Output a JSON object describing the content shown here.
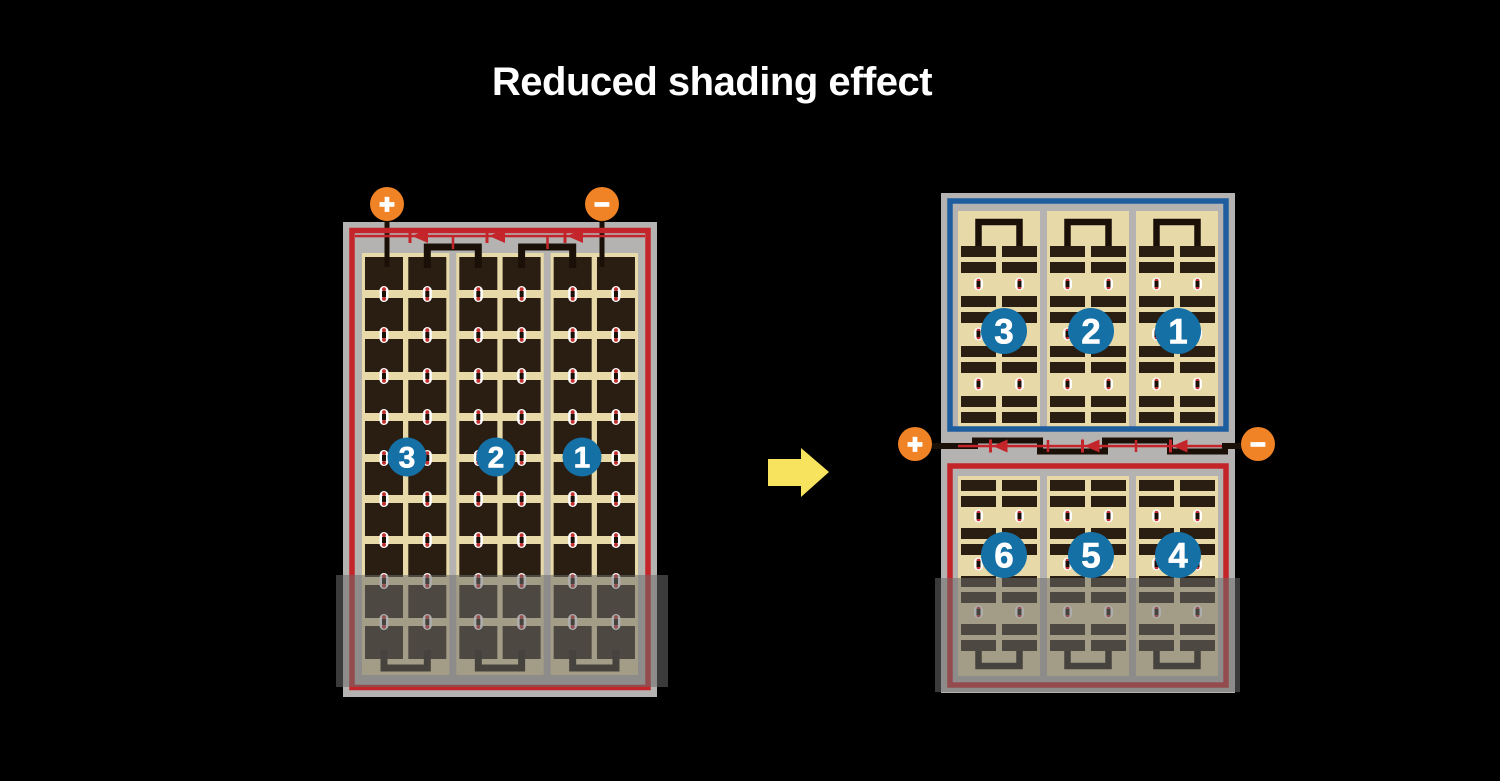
{
  "title": "Reduced shading effect",
  "colors": {
    "background": "#000000",
    "title_text": "#ffffff",
    "frame_gray": "#b5b3b2",
    "panel_tan": "#e7d9a8",
    "cell_dark": "#2a1d12",
    "wire_black": "#1a1008",
    "red": "#c4252b",
    "blue": "#1e5d9e",
    "circle_blue": "#1570a6",
    "circle_text": "#ffffff",
    "orange": "#f08326",
    "terminal_text": "#ffffff",
    "arrow_yellow": "#f8e35f",
    "shade": "rgba(108,108,108,0.55)",
    "dot_red": "#c23030",
    "dot_white": "#ffffff"
  },
  "left_panel": {
    "string_labels": [
      "3",
      "2",
      "1"
    ],
    "terminals": {
      "positive": "+",
      "negative": "−"
    }
  },
  "right_panel": {
    "top_string_labels": [
      "3",
      "2",
      "1"
    ],
    "bottom_string_labels": [
      "6",
      "5",
      "4"
    ],
    "terminals": {
      "positive": "+",
      "negative": "−"
    }
  }
}
